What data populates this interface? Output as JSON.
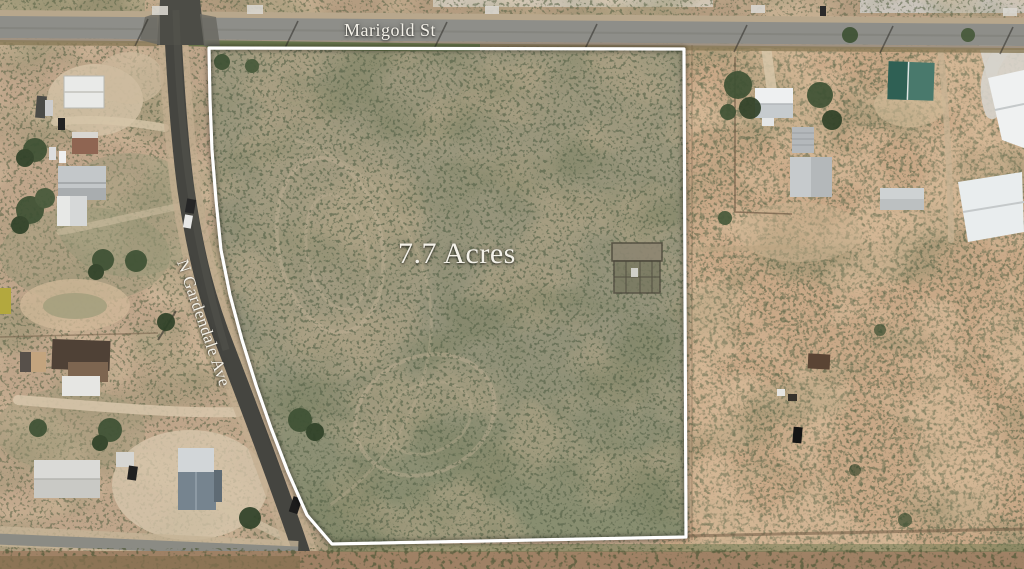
{
  "map": {
    "labels": {
      "top_street": "Marigold St",
      "left_street": "N Gardendale Ave",
      "parcel_acreage": "7.7 Acres"
    },
    "parcel": {
      "acres": 7.7,
      "boundary_color": "#ffffff"
    },
    "colors": {
      "parcel_field": "#93927a",
      "left_field": "#bfa58a",
      "right_field": "#c9a887",
      "paved_road_gray": "#8e8e89",
      "asphalt_dark": "#454540",
      "dirt_path": "#d8c7ab",
      "tree_green": "#3e5134",
      "green_shed_roof": "#2f6054",
      "label_text": "#f4f1e8"
    }
  }
}
